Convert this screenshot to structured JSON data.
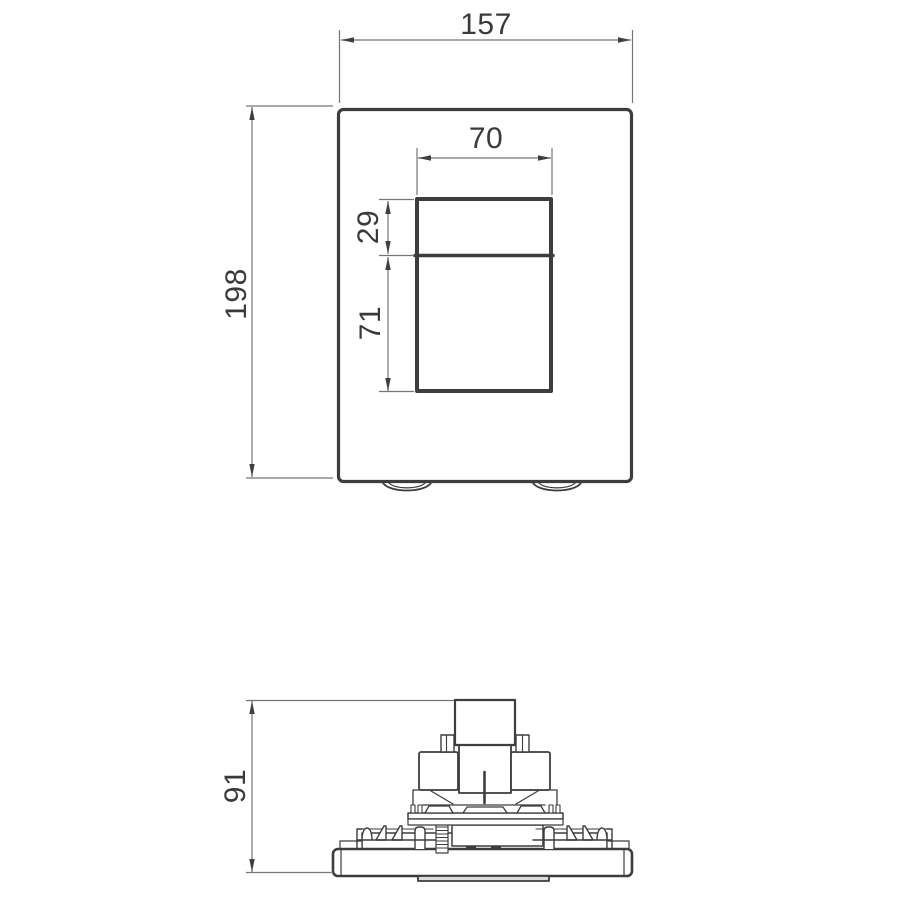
{
  "drawing": {
    "front_view": {
      "overall_width_mm": "157",
      "overall_height_mm": "198",
      "button_opening_width_mm": "70",
      "upper_button_height_mm": "29",
      "lower_button_height_mm": "71"
    },
    "side_view": {
      "overall_depth_mm": "91"
    },
    "colors": {
      "part_line": "#3d3d3d",
      "dimension_line": "#757575",
      "text": "#3a3a3a",
      "background": "#ffffff"
    }
  }
}
